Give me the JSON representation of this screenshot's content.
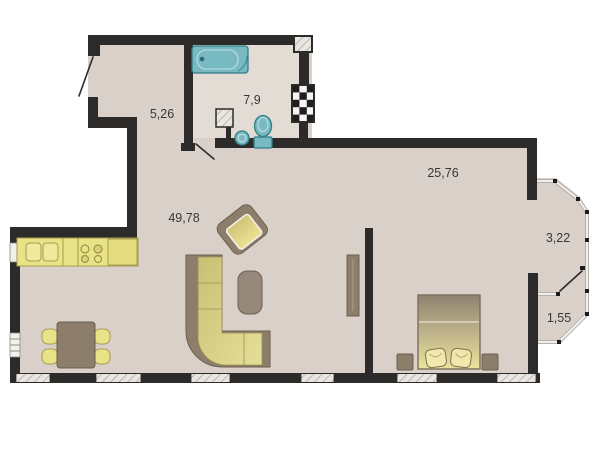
{
  "plan_title": "apartment-floor-plan",
  "rooms": [
    {
      "name": "hallway",
      "area_label": "5,26"
    },
    {
      "name": "bathroom",
      "area_label": "7,9"
    },
    {
      "name": "living-room-kitchen",
      "area_label": "49,78"
    },
    {
      "name": "bedroom",
      "area_label": "25,76"
    },
    {
      "name": "balcony-section-upper",
      "area_label": "3,22"
    },
    {
      "name": "balcony-section-lower",
      "area_label": "1,55"
    }
  ],
  "furniture": [
    "bathtub",
    "toilet",
    "wash-basin",
    "kitchen-counter",
    "dining-table",
    "dining-chairs",
    "corner-sofa",
    "armchair",
    "coffee-table",
    "wardrobe",
    "double-bed",
    "nightstands"
  ],
  "colors": {
    "outside": "#ffffff",
    "wall": "#2c2b29",
    "floor": "#d8d0c9",
    "floorBath": "#e3dcd5",
    "teal": "#79bac2",
    "tealDark": "#2f7d89",
    "yellow": "#e9e388",
    "yellowBorder": "#a79b4f",
    "brown": "#8d7e6b",
    "brownDark": "#6b5f4f",
    "cushionLight": "#e6df97",
    "cushionDark": "#c9bf74",
    "bedTop": "#8f8270",
    "bedBottom": "#ece39b",
    "hatchBg": "#e9e5e0",
    "hatchLine": "#a6a29c"
  }
}
